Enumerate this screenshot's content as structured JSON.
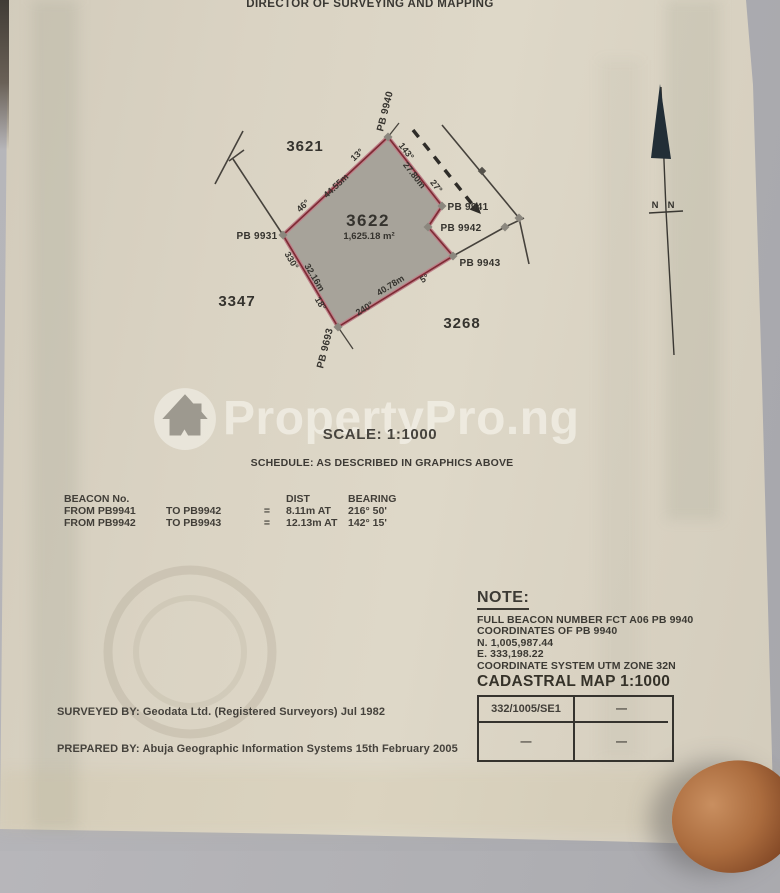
{
  "header": {
    "title": "DIRECTOR OF SURVEYING AND MAPPING"
  },
  "diagram": {
    "plot": {
      "number": "3622",
      "area": "1,625.18 m²"
    },
    "neighbors": {
      "top_left": "3621",
      "bottom_left": "3347",
      "bottom_right": "3268"
    },
    "beacons": {
      "pb9940": "PB 9940",
      "pb9941": "PB 9941",
      "pb9942": "PB 9942",
      "pb9943": "PB 9943",
      "pb9931": "PB 9931",
      "pb9693": "PB 9693"
    },
    "edges": {
      "nw": {
        "bearing_top": "13°",
        "length": "44.55m",
        "bearing_bottom": "46°"
      },
      "ne": {
        "bearing_top": "143°",
        "length": "27.80m",
        "bearing_bottom": "27°"
      },
      "sw": {
        "bearing_top": "330°",
        "length": "32.16m",
        "bearing_bottom": "18°"
      },
      "se": {
        "bearing_left": "240°",
        "length": "40.78m",
        "bearing_right": "5°"
      }
    }
  },
  "compass": {
    "label_left": "N",
    "label_right": "N"
  },
  "watermark": {
    "text": "PropertyPro.ng",
    "icon": "house-in-circle"
  },
  "scale": {
    "label": "SCALE: 1:1000"
  },
  "schedule": {
    "label": "SCHEDULE: AS DESCRIBED IN GRAPHICS ABOVE"
  },
  "beacon_table": {
    "header": {
      "col1": "BEACON No.",
      "dist": "DIST",
      "bearing": "BEARING"
    },
    "rows": [
      {
        "from": "FROM  PB9941",
        "to": "TO  PB9942",
        "eq": "=",
        "dist": "8.11m  AT",
        "bearing": "216° 50'"
      },
      {
        "from": "FROM  PB9942",
        "to": "TO  PB9943",
        "eq": "=",
        "dist": "12.13m  AT",
        "bearing": "142° 15'"
      }
    ]
  },
  "note": {
    "title": "NOTE:",
    "lines": [
      "FULL BEACON NUMBER FCT A06 PB 9940",
      "COORDINATES OF PB 9940",
      "N. 1,005,987.44",
      "E. 333,198.22",
      "COORDINATE SYSTEM UTM ZONE 32N"
    ]
  },
  "cadastral": {
    "title": "CADASTRAL MAP 1:1000",
    "cells": [
      [
        "332/1005/SE1",
        "—"
      ],
      [
        "—",
        "—"
      ]
    ]
  },
  "footer": {
    "surveyed_by": "SURVEYED BY: Geodata Ltd. (Registered Surveyors)  Jul 1982",
    "prepared_by": "PREPARED BY: Abuja Geographic Information Systems  15th February 2005"
  },
  "colors": {
    "paper": "#ddd7c7",
    "desk": "#afafb3",
    "plot_fill": "#a7a39a",
    "plot_boundary": "#7e2a33",
    "ink": "#35332e",
    "fingertip": "#a96b3e"
  }
}
